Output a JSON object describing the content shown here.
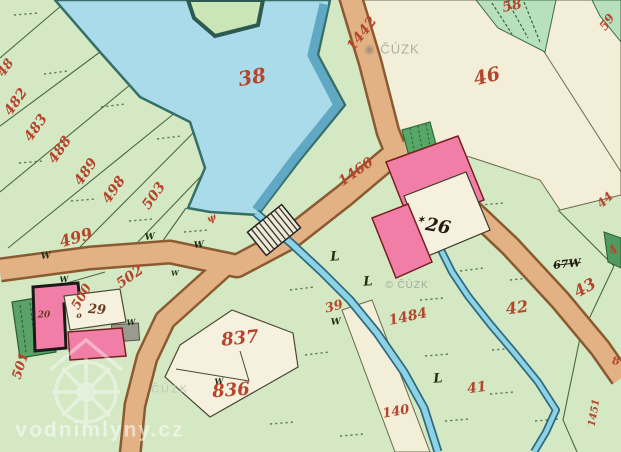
{
  "canvas": {
    "width": 621,
    "height": 452
  },
  "colors": {
    "base_green": "#d3e8c3",
    "mint_green": "#b9e0bd",
    "dark_green": "#4f9a5e",
    "pond_blue": "#a9dbea",
    "pond_edge": "#356f66",
    "road_tan": "#e2b184",
    "road_edge": "#8a5a30",
    "beige_parcel": "#f3eed8",
    "cream_yard": "#f6f1de",
    "building_pink": "#f17ea6",
    "red_number": "#b5452c",
    "black_number": "#241c12",
    "watermark_white": "#ffffff",
    "watermark_gray": "#787878"
  },
  "labels": [
    {
      "name": "parcel-48-partial",
      "text": "48",
      "x": 6,
      "y": 68,
      "size": 13,
      "rot": -55,
      "cls": "red"
    },
    {
      "name": "parcel-482",
      "text": "482",
      "x": 16,
      "y": 102,
      "size": 14,
      "rot": -55,
      "cls": "red"
    },
    {
      "name": "parcel-483",
      "text": "483",
      "x": 36,
      "y": 128,
      "size": 14,
      "rot": -55,
      "cls": "red"
    },
    {
      "name": "parcel-488",
      "text": "488",
      "x": 60,
      "y": 150,
      "size": 14,
      "rot": -55,
      "cls": "red"
    },
    {
      "name": "parcel-489",
      "text": "489",
      "x": 86,
      "y": 172,
      "size": 14,
      "rot": -55,
      "cls": "red"
    },
    {
      "name": "parcel-498",
      "text": "498",
      "x": 114,
      "y": 190,
      "size": 14,
      "rot": -55,
      "cls": "red"
    },
    {
      "name": "parcel-503",
      "text": "503",
      "x": 154,
      "y": 196,
      "size": 14,
      "rot": -55,
      "cls": "red"
    },
    {
      "name": "parcel-499",
      "text": "499",
      "x": 76,
      "y": 238,
      "size": 16,
      "rot": -16,
      "cls": "red"
    },
    {
      "name": "parcel-500",
      "text": "500",
      "x": 82,
      "y": 297,
      "size": 13,
      "rot": -60,
      "cls": "red"
    },
    {
      "name": "parcel-501",
      "text": "501",
      "x": 21,
      "y": 366,
      "size": 13,
      "rot": -72,
      "cls": "red"
    },
    {
      "name": "parcel-502",
      "text": "502",
      "x": 130,
      "y": 277,
      "size": 14,
      "rot": -35,
      "cls": "red"
    },
    {
      "name": "pond-38",
      "text": "38",
      "x": 252,
      "y": 77,
      "size": 20,
      "rot": -10,
      "cls": "red"
    },
    {
      "name": "parcel-837",
      "text": "837",
      "x": 240,
      "y": 339,
      "size": 18,
      "rot": -6,
      "cls": "red"
    },
    {
      "name": "parcel-836",
      "text": "836",
      "x": 231,
      "y": 391,
      "size": 18,
      "rot": -4,
      "cls": "red"
    },
    {
      "name": "road-1442",
      "text": "1442",
      "x": 362,
      "y": 34,
      "size": 14,
      "rot": -52,
      "cls": "red"
    },
    {
      "name": "road-1460",
      "text": "1460",
      "x": 356,
      "y": 172,
      "size": 14,
      "rot": -35,
      "cls": "red"
    },
    {
      "name": "parcel-46",
      "text": "46",
      "x": 487,
      "y": 77,
      "size": 19,
      "rot": -14,
      "cls": "red"
    },
    {
      "name": "parcel-58",
      "text": "58",
      "x": 512,
      "y": 6,
      "size": 14,
      "rot": -12,
      "cls": "red"
    },
    {
      "name": "parcel-59",
      "text": "59",
      "x": 607,
      "y": 22,
      "size": 12,
      "rot": -55,
      "cls": "red"
    },
    {
      "name": "parcel-44-partial",
      "text": "44",
      "x": 605,
      "y": 200,
      "size": 12,
      "rot": -42,
      "cls": "red"
    },
    {
      "name": "parcel-4-partial",
      "text": "4",
      "x": 613,
      "y": 250,
      "size": 12,
      "rot": -42,
      "cls": "red"
    },
    {
      "name": "parcel-43",
      "text": "43",
      "x": 585,
      "y": 288,
      "size": 16,
      "rot": -30,
      "cls": "red"
    },
    {
      "name": "parcel-67",
      "text": "67W",
      "x": 567,
      "y": 264,
      "size": 11,
      "rot": -6,
      "cls": "black strike"
    },
    {
      "name": "parcel-42",
      "text": "42",
      "x": 517,
      "y": 308,
      "size": 16,
      "rot": -8,
      "cls": "red"
    },
    {
      "name": "parcel-41",
      "text": "41",
      "x": 477,
      "y": 388,
      "size": 14,
      "rot": -8,
      "cls": "red"
    },
    {
      "name": "parcel-140",
      "text": "140",
      "x": 396,
      "y": 412,
      "size": 13,
      "rot": -10,
      "cls": "red"
    },
    {
      "name": "stream-1484",
      "text": "1484",
      "x": 408,
      "y": 317,
      "size": 14,
      "rot": -12,
      "cls": "red"
    },
    {
      "name": "parcel-39",
      "text": "39",
      "x": 334,
      "y": 307,
      "size": 13,
      "rot": -14,
      "cls": "red"
    },
    {
      "name": "parcel-1451",
      "text": "1451",
      "x": 595,
      "y": 413,
      "size": 10,
      "rot": -80,
      "cls": "red"
    },
    {
      "name": "parcel-8-partial",
      "text": "8",
      "x": 616,
      "y": 361,
      "size": 11,
      "rot": 0,
      "cls": "red"
    },
    {
      "name": "house-26",
      "text": "26",
      "x": 438,
      "y": 227,
      "size": 18,
      "rot": 10,
      "cls": "black"
    },
    {
      "name": "house-26-star-mark",
      "text": "✶",
      "x": 421,
      "y": 221,
      "size": 9,
      "rot": 0,
      "cls": "black"
    },
    {
      "name": "house-29",
      "text": "29",
      "x": 97,
      "y": 310,
      "size": 13,
      "rot": 4,
      "cls": "brown"
    },
    {
      "name": "house-20",
      "text": "20",
      "x": 44,
      "y": 316,
      "size": 9,
      "rot": 0,
      "cls": "brown"
    },
    {
      "name": "yard-o-mark",
      "text": "o",
      "x": 79,
      "y": 315,
      "size": 8,
      "rot": 0,
      "cls": "brown"
    },
    {
      "name": "meadow-symbol-1",
      "text": "W",
      "x": 46,
      "y": 257,
      "size": 9,
      "rot": -6,
      "cls": "sym"
    },
    {
      "name": "meadow-symbol-2",
      "text": "W",
      "x": 150,
      "y": 238,
      "size": 9,
      "rot": -6,
      "cls": "sym"
    },
    {
      "name": "meadow-symbol-3",
      "text": "W",
      "x": 199,
      "y": 246,
      "size": 9,
      "rot": -6,
      "cls": "sym"
    },
    {
      "name": "meadow-symbol-4",
      "text": "W",
      "x": 336,
      "y": 323,
      "size": 9,
      "rot": -6,
      "cls": "sym"
    },
    {
      "name": "meadow-symbol-5",
      "text": "W",
      "x": 219,
      "y": 381,
      "size": 8,
      "rot": -6,
      "cls": "sym"
    },
    {
      "name": "meadow-symbol-6",
      "text": "W",
      "x": 131,
      "y": 322,
      "size": 8,
      "rot": -6,
      "cls": "sym"
    },
    {
      "name": "meadow-symbol-7",
      "text": "W",
      "x": 64,
      "y": 279,
      "size": 8,
      "rot": -6,
      "cls": "sym"
    },
    {
      "name": "meadow-symbol-8",
      "text": "W",
      "x": 175,
      "y": 273,
      "size": 7,
      "rot": -6,
      "cls": "sym"
    },
    {
      "name": "tree-flag-symbol-1",
      "text": "L",
      "x": 335,
      "y": 257,
      "size": 13,
      "rot": -4,
      "cls": "sym"
    },
    {
      "name": "tree-flag-symbol-2",
      "text": "L",
      "x": 368,
      "y": 282,
      "size": 13,
      "rot": -4,
      "cls": "sym"
    },
    {
      "name": "tree-flag-symbol-3",
      "text": "L",
      "x": 438,
      "y": 379,
      "size": 13,
      "rot": -4,
      "cls": "sym"
    },
    {
      "name": "reed-symbol",
      "text": "ψ",
      "x": 212,
      "y": 219,
      "size": 10,
      "rot": -25,
      "cls": "red"
    },
    {
      "name": "watermark-cuzk-logo",
      "text": "◉",
      "x": 370,
      "y": 49,
      "size": 12,
      "rot": 0,
      "cls": "wm-gray"
    },
    {
      "name": "watermark-cuzk-top",
      "text": "ČÚZK",
      "x": 400,
      "y": 49,
      "size": 13,
      "rot": 0,
      "cls": "wm-gray"
    },
    {
      "name": "watermark-cuzk-mid",
      "text": "© ČÚZK",
      "x": 407,
      "y": 286,
      "size": 10,
      "rot": 0,
      "cls": "wm-gray"
    },
    {
      "name": "watermark-cuzk-low",
      "text": "ČÚZK",
      "x": 170,
      "y": 390,
      "size": 11,
      "rot": 0,
      "cls": "wm-gray2"
    },
    {
      "name": "watermark-vodnimlyny",
      "text": "vodnimlyny.cz",
      "x": 100,
      "y": 430,
      "size": 21,
      "rot": 0,
      "cls": "wm-white"
    }
  ]
}
